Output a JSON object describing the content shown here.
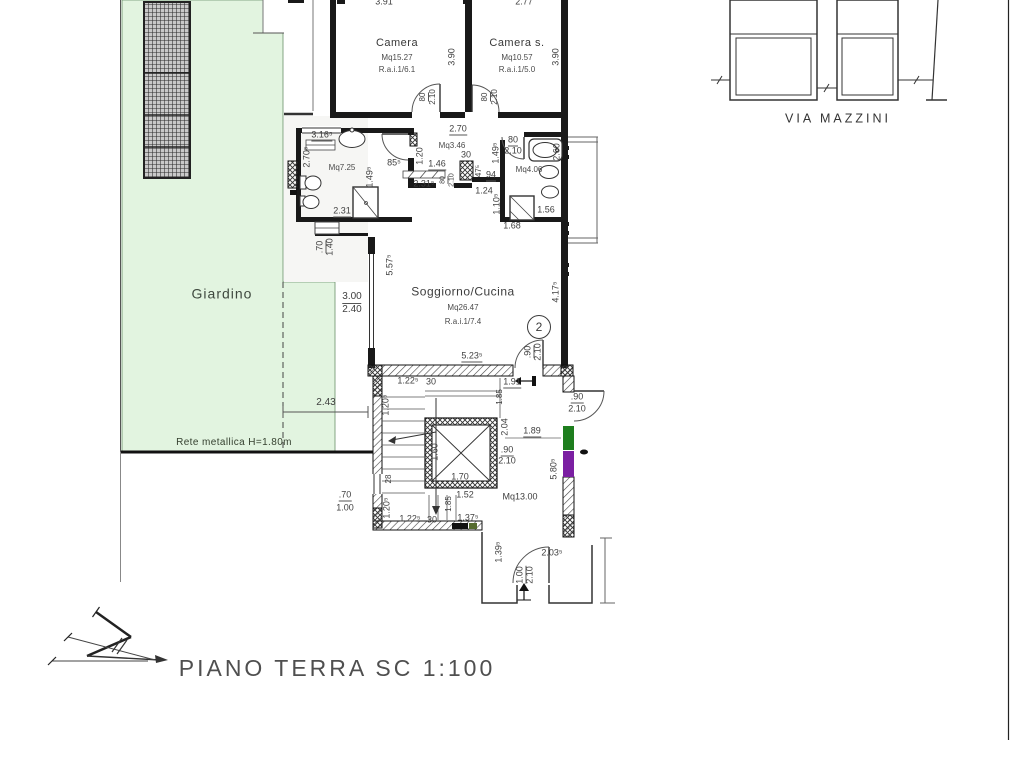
{
  "drawing": {
    "title": "PIANO TERRA SC 1:100",
    "street": "VIA MAZZINI",
    "unit_number": "2",
    "garden": {
      "label": "Giardino",
      "fence_note": "Rete metallica H=1.80m",
      "boundary_dim": "2.43"
    },
    "rooms": {
      "camera": {
        "name": "Camera",
        "area": "Mq15.27",
        "rai": "R.a.i.1/6.1"
      },
      "camera_s": {
        "name": "Camera s.",
        "area": "Mq10.57",
        "rai": "R.a.i.1/5.0"
      },
      "bagno_1": {
        "area": "Mq7.25"
      },
      "disimpegno": {
        "area": "Mq3.46"
      },
      "bagno_2": {
        "area": "Mq4.06"
      },
      "soggiorno": {
        "name": "Soggiorno/Cucina",
        "area": "Mq26.47",
        "rai": "R.a.i.1/7.4"
      },
      "vano_scale": {
        "area": "Mq13.00"
      }
    },
    "colors": {
      "garden_fill": "#e2f4e0",
      "marker_green": "#1e7e1e",
      "marker_purple": "#7b1fa2"
    },
    "annotations": [
      {
        "t": "3.91",
        "x": 384,
        "y": 2,
        "s": 9
      },
      {
        "t": "2.77",
        "x": 524,
        "y": 2,
        "s": 9
      },
      {
        "t": "3.90",
        "x": 452,
        "y": 57,
        "s": 9,
        "r": 1
      },
      {
        "t": "3.90",
        "x": 556,
        "y": 57,
        "s": 9,
        "r": 1
      },
      {
        "t": "80",
        "x": 424,
        "y": 97,
        "s": 8,
        "r": 1,
        "u": 1
      },
      {
        "t": "2.10",
        "x": 433,
        "y": 97,
        "s": 8,
        "r": 1
      },
      {
        "t": "80",
        "x": 486,
        "y": 97,
        "s": 8,
        "r": 1,
        "u": 1
      },
      {
        "t": "2.10",
        "x": 495,
        "y": 97,
        "s": 8,
        "r": 1
      },
      {
        "t": "2.70",
        "x": 458,
        "y": 130,
        "s": 9,
        "u": 1
      },
      {
        "t": "3.16⁵",
        "x": 322,
        "y": 136,
        "s": 9,
        "u": 1
      },
      {
        "t": "2.70⁵",
        "x": 307,
        "y": 157,
        "s": 9,
        "r": 1
      },
      {
        "t": "1.49⁵",
        "x": 370,
        "y": 177,
        "s": 9,
        "r": 1
      },
      {
        "t": "85⁵",
        "x": 394,
        "y": 163,
        "s": 9
      },
      {
        "t": "1.20",
        "x": 420,
        "y": 156,
        "s": 9,
        "r": 1
      },
      {
        "t": "1.46",
        "x": 437,
        "y": 165,
        "s": 9,
        "u": 1
      },
      {
        "t": "2.31⁵",
        "x": 424,
        "y": 184,
        "s": 9
      },
      {
        "t": "80",
        "x": 444,
        "y": 180,
        "s": 7,
        "r": 1,
        "u": 1
      },
      {
        "t": "2.10",
        "x": 452,
        "y": 180,
        "s": 7,
        "r": 1
      },
      {
        "t": "30",
        "x": 466,
        "y": 155,
        "s": 9
      },
      {
        "t": "47⁵",
        "x": 479,
        "y": 171,
        "s": 8,
        "r": 1
      },
      {
        "t": "94",
        "x": 491,
        "y": 176,
        "s": 9,
        "u": 1
      },
      {
        "t": "1.24",
        "x": 484,
        "y": 191,
        "s": 9
      },
      {
        "t": "80",
        "x": 513,
        "y": 141,
        "s": 9,
        "u": 1
      },
      {
        "t": "2.10",
        "x": 513,
        "y": 151,
        "s": 9
      },
      {
        "t": "1.49⁵",
        "x": 496,
        "y": 153,
        "s": 9,
        "r": 1
      },
      {
        "t": "2.60",
        "x": 557,
        "y": 152,
        "s": 9,
        "r": 1
      },
      {
        "t": "1.10⁵",
        "x": 497,
        "y": 204,
        "s": 9,
        "r": 1
      },
      {
        "t": "1.56",
        "x": 546,
        "y": 210,
        "s": 9
      },
      {
        "t": "1.68",
        "x": 512,
        "y": 226,
        "s": 9
      },
      {
        "t": "2.31",
        "x": 342,
        "y": 212,
        "s": 9,
        "u": 1
      },
      {
        "t": ".70",
        "x": 321,
        "y": 247,
        "s": 9,
        "r": 1,
        "u": 1
      },
      {
        "t": "1.40",
        "x": 330,
        "y": 247,
        "s": 9,
        "r": 1
      },
      {
        "t": "3.00",
        "x": 352,
        "y": 298,
        "s": 10,
        "u": 1
      },
      {
        "t": "2.40",
        "x": 352,
        "y": 310,
        "s": 10
      },
      {
        "t": "5.57⁵",
        "x": 390,
        "y": 265,
        "s": 9,
        "r": 1
      },
      {
        "t": "4.17⁵",
        "x": 556,
        "y": 292,
        "s": 9,
        "r": 1
      },
      {
        "t": "5.23⁵",
        "x": 472,
        "y": 357,
        "s": 9,
        "u": 1
      },
      {
        "t": ".90",
        "x": 529,
        "y": 352,
        "s": 9,
        "r": 1,
        "u": 1
      },
      {
        "t": "2.10",
        "x": 538,
        "y": 352,
        "s": 9,
        "r": 1
      },
      {
        "t": "2.43",
        "x": 326,
        "y": 403,
        "s": 10
      },
      {
        "t": "1.22⁵",
        "x": 408,
        "y": 381,
        "s": 9
      },
      {
        "t": "30",
        "x": 431,
        "y": 382,
        "s": 9
      },
      {
        "t": "1.91",
        "x": 512,
        "y": 383,
        "s": 9,
        "u": 1
      },
      {
        "t": "1.85",
        "x": 500,
        "y": 397,
        "s": 8,
        "r": 1
      },
      {
        "t": "1.20⁵",
        "x": 386,
        "y": 405,
        "s": 9,
        "r": 1
      },
      {
        "t": "2.04",
        "x": 505,
        "y": 427,
        "s": 9,
        "r": 1
      },
      {
        "t": "1.89",
        "x": 532,
        "y": 432,
        "s": 9,
        "u": 1
      },
      {
        "t": ".90",
        "x": 507,
        "y": 451,
        "s": 9,
        "u": 1
      },
      {
        "t": "2.10",
        "x": 507,
        "y": 461,
        "s": 9
      },
      {
        "t": ".90",
        "x": 577,
        "y": 398,
        "s": 9,
        "u": 1
      },
      {
        "t": "2.10",
        "x": 577,
        "y": 409,
        "s": 9
      },
      {
        "t": "1.60",
        "x": 435,
        "y": 452,
        "s": 9,
        "r": 1
      },
      {
        "t": "1.70",
        "x": 460,
        "y": 477,
        "s": 9
      },
      {
        "t": "28",
        "x": 389,
        "y": 479,
        "s": 8,
        "r": 1
      },
      {
        "t": "5.80⁵",
        "x": 554,
        "y": 469,
        "s": 9,
        "r": 1
      },
      {
        "t": "1.52",
        "x": 465,
        "y": 495,
        "s": 9
      },
      {
        "t": "1.20⁵",
        "x": 387,
        "y": 508,
        "s": 9,
        "r": 1
      },
      {
        "t": "1.85",
        "x": 449,
        "y": 504,
        "s": 8,
        "r": 1
      },
      {
        "t": "1.22⁵",
        "x": 410,
        "y": 519,
        "s": 9
      },
      {
        "t": "30",
        "x": 432,
        "y": 520,
        "s": 9
      },
      {
        "t": "1.37⁵",
        "x": 468,
        "y": 518,
        "s": 9
      },
      {
        "t": ".70",
        "x": 345,
        "y": 496,
        "s": 9,
        "u": 1
      },
      {
        "t": "1.00",
        "x": 345,
        "y": 508,
        "s": 9
      },
      {
        "t": "1.39⁵",
        "x": 499,
        "y": 552,
        "s": 9,
        "r": 1
      },
      {
        "t": "2.03⁵",
        "x": 552,
        "y": 553,
        "s": 9
      },
      {
        "t": "1.00",
        "x": 521,
        "y": 575,
        "s": 9,
        "r": 1,
        "u": 1
      },
      {
        "t": "2.10",
        "x": 530,
        "y": 575,
        "s": 9,
        "r": 1
      }
    ]
  }
}
